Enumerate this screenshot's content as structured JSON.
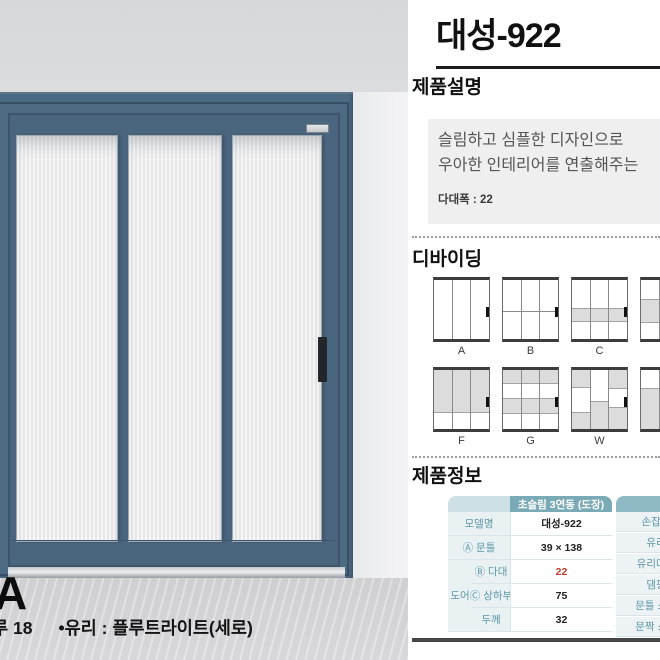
{
  "page": {
    "title": "대성-922"
  },
  "left_panel": {
    "variant_letter": "A",
    "caption_prefix": "루 18",
    "caption_glass": "•유리 : 플루트라이트(세로)",
    "badge_icon": "brand-plate-icon",
    "door_color": "#4d6a83",
    "glass_style": "플루트라이트(세로)"
  },
  "sections": {
    "description": {
      "heading": "제품설명",
      "line1": "슬림하고 심플한 디자인으로",
      "line2": "우아한 인테리어를 연출해주는",
      "note": "다대폭 : 22"
    },
    "dividing": {
      "heading": "디바이딩",
      "row1_labels": [
        "A",
        "B",
        "C"
      ],
      "row2_labels": [
        "F",
        "G",
        "W"
      ]
    },
    "product_info": {
      "heading": "제품정보",
      "table": {
        "header": "초슬림 3연동 (도장)",
        "group_label": "도어",
        "rows": [
          {
            "label": "모델명",
            "value": "대성-922"
          },
          {
            "label": "Ⓐ 문틀",
            "value": "39 × 138"
          },
          {
            "label": "Ⓑ 다대",
            "value": "22"
          },
          {
            "label": "Ⓒ 상하부",
            "value": "75"
          },
          {
            "label": "두께",
            "value": "32"
          }
        ]
      },
      "right_labels": [
        "손잡이",
        "유리",
        "유리마감",
        "댐핑",
        "문틀 소재",
        "문짝 소재"
      ]
    }
  },
  "colors": {
    "accent_teal": "#79aab6",
    "header_light_teal": "#cfe0e5",
    "label_bg": "#eaf1f3",
    "label_text": "#5d97a6",
    "highlight_red": "#c23b2e",
    "door_blue": "#4d6a83",
    "rule_dark": "#474747"
  }
}
